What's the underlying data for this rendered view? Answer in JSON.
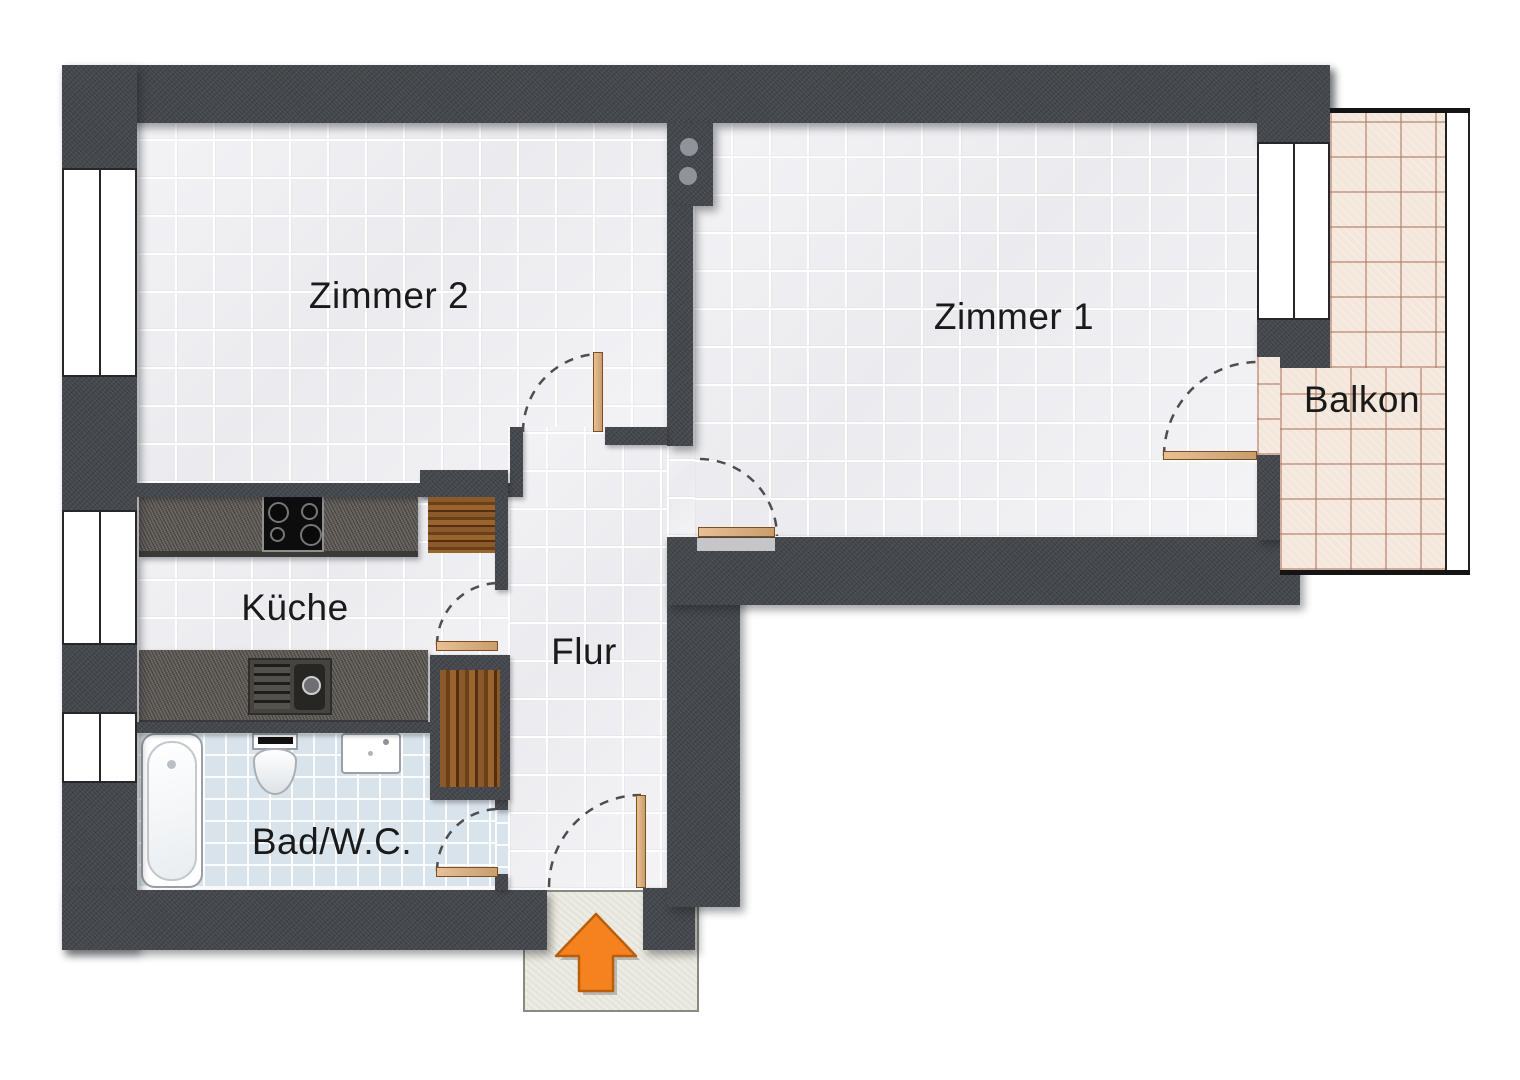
{
  "floorplan": {
    "kind": "apartment-floor-plan",
    "language": "de",
    "rooms": [
      {
        "id": "zimmer2",
        "label": "Zimmer 2"
      },
      {
        "id": "zimmer1",
        "label": "Zimmer 1"
      },
      {
        "id": "kueche",
        "label": "Küche"
      },
      {
        "id": "flur",
        "label": "Flur"
      },
      {
        "id": "bad_wc",
        "label": "Bad/W.C."
      },
      {
        "id": "balkon",
        "label": "Balkon"
      }
    ],
    "symbols": {
      "windows_left_wall": 3,
      "windows_zimmer1": 1,
      "door_swings": 6,
      "entry_marker": "orange-arrow-up",
      "kitchen": [
        "stove-4-burners",
        "sink-with-drainboard",
        "wardrobe-niche-upper",
        "wardrobe-niche-lower"
      ],
      "bathroom": [
        "bathtub",
        "toilet",
        "washbasin"
      ]
    },
    "colors": {
      "wall": "#44474c",
      "room_tile": "#eeeef2",
      "bath_tile": "#d9e3eb",
      "balcony_tile": "#f3e6da",
      "entry_pad": "#edece3",
      "wood": "#81511f",
      "counter": "#5f5b57",
      "door_leaf": "#dcb184",
      "arrow": "#f6821f",
      "label_text": "#1a1a1a"
    }
  }
}
